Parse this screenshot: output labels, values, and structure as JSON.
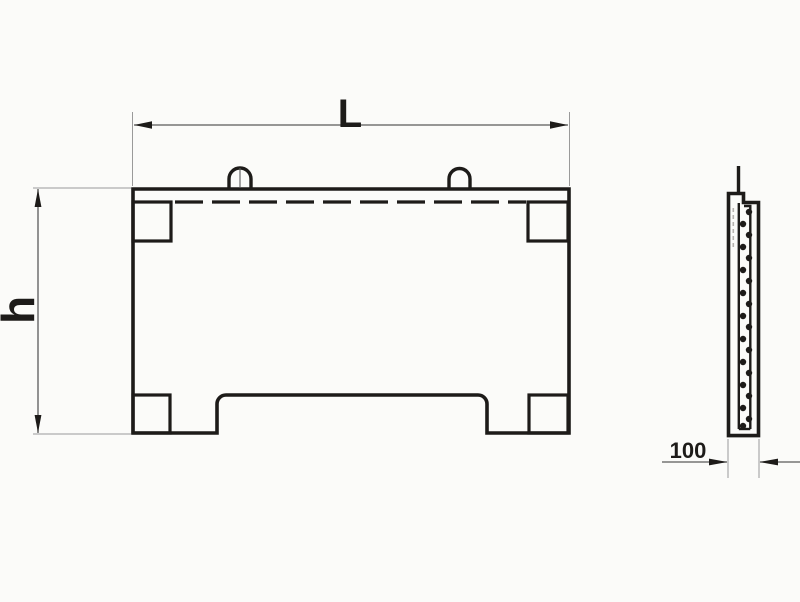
{
  "drawing": {
    "type": "technical-drawing",
    "views": {
      "front": "panel front elevation with two lifting loops, four corner notches, dashed reinforcement line and bottom recess",
      "side": "panel side section with rebar dots and lifting loop wire"
    }
  },
  "dimensions": {
    "length": {
      "label": "L"
    },
    "height": {
      "label": "h"
    },
    "thickness": {
      "label": "100"
    }
  },
  "colors": {
    "line": "#1d1b19",
    "dim": "#5a5a5a",
    "ext": "#9a9a9a",
    "hidden": "#b5b2ae",
    "bg": "#fbfbf9"
  }
}
